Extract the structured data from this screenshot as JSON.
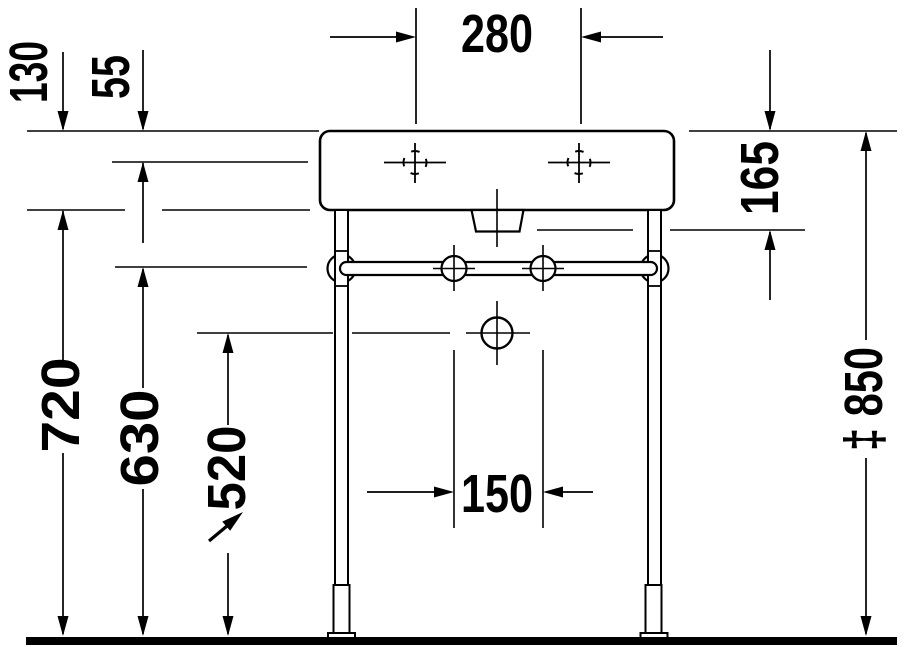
{
  "dimensions": {
    "tap_hole_spacing": "280",
    "rim_to_body_bottom": "130",
    "rim_to_tap_axis": "55",
    "rim_to_outlet_bottom": "165",
    "floor_to_basin_bottom": "720",
    "floor_to_towel_rail": "630",
    "floor_to_drain_axis": "520",
    "fixing_spacing": "150",
    "overall_height": "‡ 850"
  }
}
